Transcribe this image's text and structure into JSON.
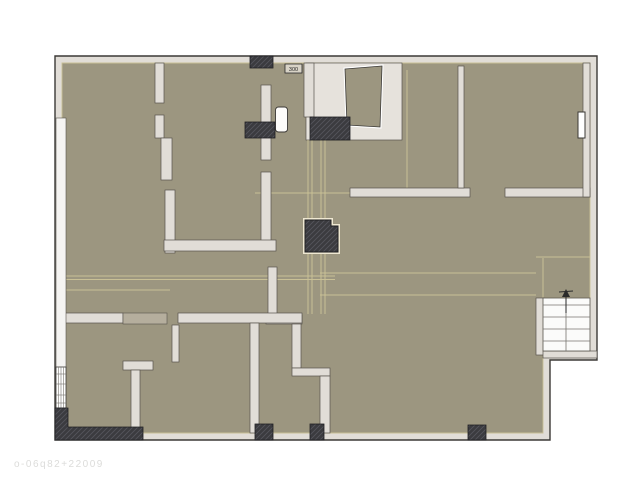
{
  "watermark": {
    "text": "o-06q82+22009"
  },
  "plan": {
    "label_box": {
      "x": 285,
      "y": 64,
      "w": 17,
      "h": 9,
      "text": "300"
    },
    "colors": {
      "floor": "#9C9680",
      "floor_accent": "#C9C096",
      "wall_fill": "#E1DDD7",
      "wall_stroke": "#57534C",
      "outer_stroke": "#3B3936",
      "dark_block": "#3B3B3F",
      "dark_stroke": "#1F1F22",
      "hatch_line": "#55555C",
      "column_outline": "#EFE8D2",
      "nook_fill": "#E6E2DC",
      "stair_bg": "#FBFBFA",
      "stair_line": "#77746F",
      "window_bg": "#F5F4F2",
      "threshold_block": "#B5AE9D",
      "watermark_color": "#DCDCDA"
    },
    "footprint_points": "55,56 597,56 597,360 550,360 550,440 55,440",
    "floor_points": "62,63 590,63 590,298 543,298 543,433 62,433",
    "nook_rect": [
      306,
      63,
      96,
      77
    ],
    "trapezoid_points": "345,69 382,66 380,127 347,125",
    "walls": [
      [
        155,
        63,
        9,
        40
      ],
      [
        155,
        115,
        9,
        23
      ],
      [
        161,
        138,
        11,
        42
      ],
      [
        165,
        190,
        10,
        63
      ],
      [
        261,
        85,
        10,
        75
      ],
      [
        261,
        172,
        10,
        70
      ],
      [
        304,
        63,
        10,
        54
      ],
      [
        164,
        240,
        112,
        11
      ],
      [
        268,
        267,
        9,
        51
      ],
      [
        266,
        315,
        36,
        9
      ],
      [
        292,
        324,
        9,
        44
      ],
      [
        292,
        368,
        38,
        8
      ],
      [
        320,
        376,
        10,
        57
      ],
      [
        350,
        188,
        120,
        9
      ],
      [
        505,
        188,
        85,
        9
      ],
      [
        458,
        66,
        6,
        122
      ],
      [
        583,
        63,
        7,
        134
      ],
      [
        62,
        313,
        61,
        10
      ],
      [
        178,
        313,
        124,
        10
      ],
      [
        172,
        325,
        7,
        37
      ],
      [
        123,
        361,
        30,
        9
      ],
      [
        131,
        370,
        9,
        63
      ],
      [
        250,
        323,
        9,
        110
      ],
      [
        536,
        298,
        8,
        57
      ],
      [
        543,
        351,
        54,
        7
      ]
    ],
    "threshold_rect": [
      123,
      313,
      44,
      11
    ],
    "dark_blocks": [
      [
        250,
        56,
        23,
        12
      ],
      [
        245,
        122,
        30,
        16
      ],
      [
        310,
        117,
        40,
        23
      ],
      [
        255,
        424,
        18,
        16
      ],
      [
        310,
        424,
        14,
        16
      ],
      [
        468,
        425,
        18,
        15
      ]
    ],
    "corner_block_points": "55,408 68,408 68,427 143,427 143,440 55,440",
    "column_points": "305,220 331,220 331,226 338,226 338,252 305,252",
    "cavity_rect": [
      56,
      118,
      10,
      250
    ],
    "window_left": {
      "rect": [
        56,
        367,
        10,
        41
      ],
      "vlines": [
        58.5,
        61,
        63.5
      ],
      "rungs": [
        374,
        384,
        395,
        403
      ]
    },
    "right_marker_rect": [
      578,
      112,
      7,
      26
    ],
    "door_leaf_rect": [
      275.5,
      107,
      12,
      25
    ],
    "stair": {
      "rect": [
        543,
        298,
        47,
        53
      ],
      "treads": [
        305,
        317,
        329,
        341
      ],
      "rail_x": 566,
      "arrow": {
        "line": [
          566,
          294,
          566,
          313
        ],
        "head": "562,297 570,297 566,289",
        "tick": [
          559,
          292,
          573,
          291
        ]
      }
    },
    "seams": [
      [
        308,
        140,
        308,
        218
      ],
      [
        312,
        140,
        312,
        218
      ],
      [
        308,
        252,
        308,
        314
      ],
      [
        312,
        252,
        312,
        314
      ],
      [
        321,
        140,
        321,
        218
      ],
      [
        325,
        140,
        325,
        218
      ],
      [
        321,
        252,
        321,
        314
      ],
      [
        325,
        252,
        325,
        314
      ],
      [
        255,
        193,
        350,
        193
      ],
      [
        62,
        276,
        335,
        276
      ],
      [
        62,
        279.5,
        335,
        279.5
      ],
      [
        62,
        290,
        170,
        290
      ],
      [
        320,
        273,
        536,
        273
      ],
      [
        320,
        295,
        536,
        295
      ],
      [
        536,
        257,
        590,
        257
      ],
      [
        543,
        258,
        543,
        298
      ],
      [
        407,
        70,
        407,
        188
      ]
    ]
  }
}
